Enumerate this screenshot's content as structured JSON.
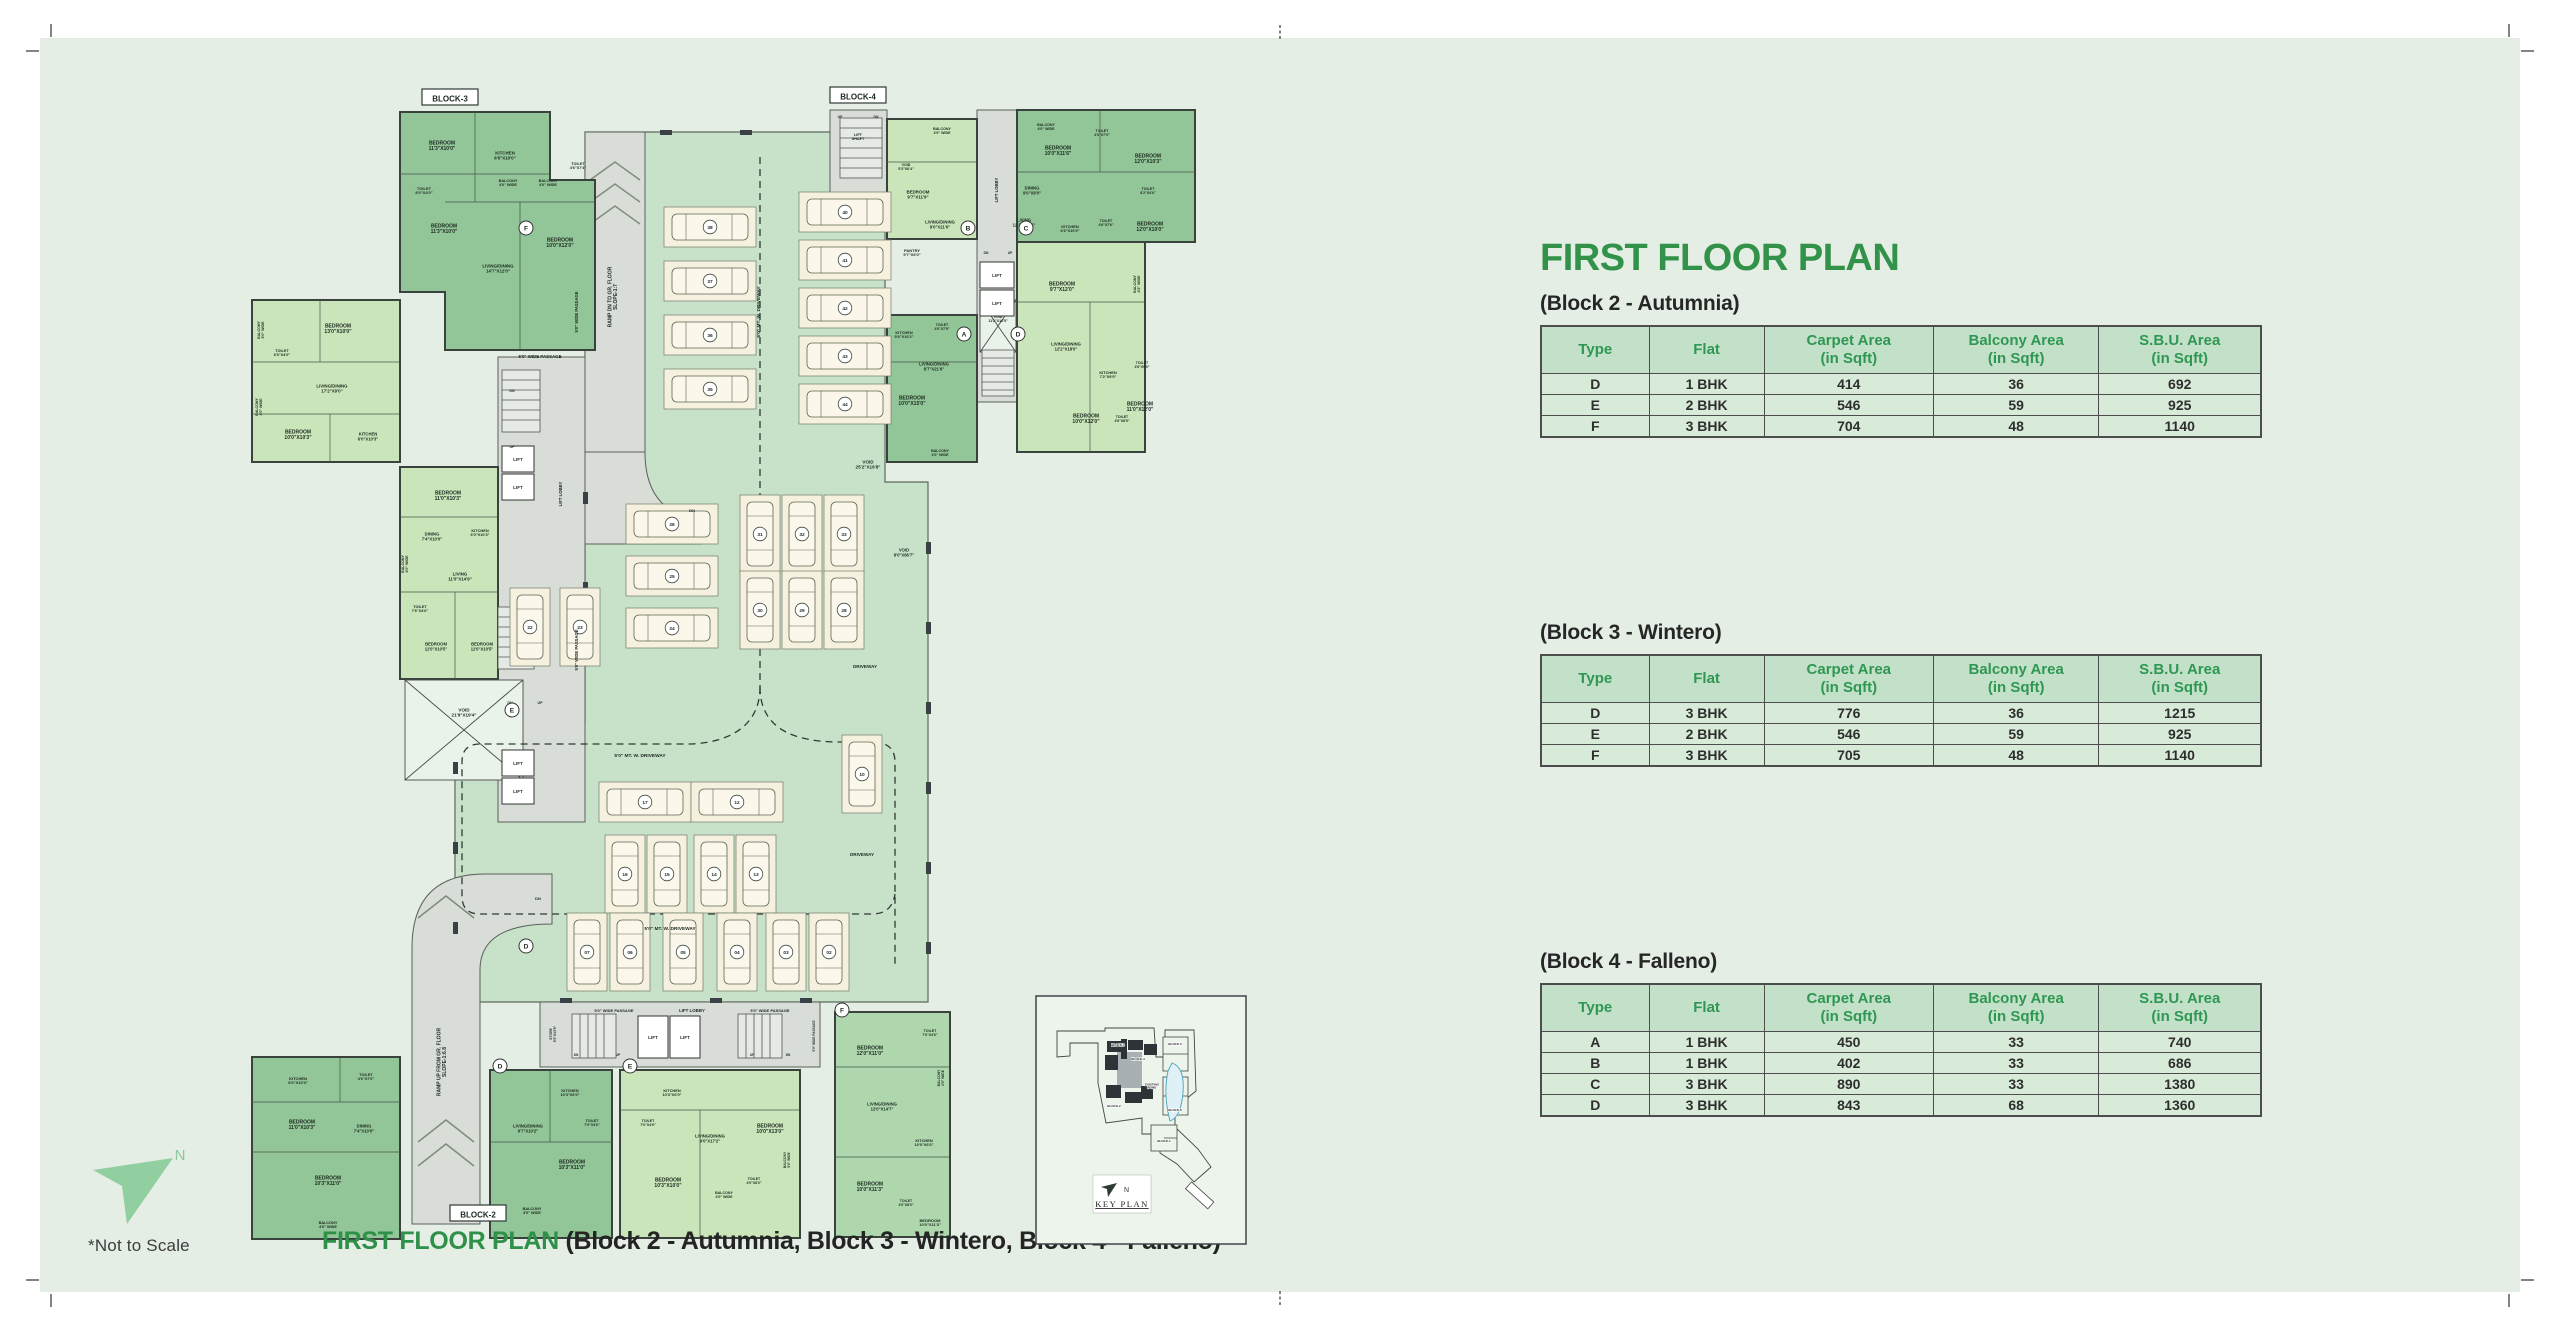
{
  "header": {
    "title": "FIRST FLOOR PLAN"
  },
  "tables": [
    {
      "caption": "(Block 2 - Autumnia)",
      "columns": [
        "Type",
        "Flat",
        "Carpet Area\n(in Sqft)",
        "Balcony Area\n(in Sqft)",
        "S.B.U. Area\n(in Sqft)"
      ],
      "rows": [
        [
          "D",
          "1 BHK",
          "414",
          "36",
          "692"
        ],
        [
          "E",
          "2 BHK",
          "546",
          "59",
          "925"
        ],
        [
          "F",
          "3 BHK",
          "704",
          "48",
          "1140"
        ]
      ]
    },
    {
      "caption": "(Block 3 - Wintero)",
      "columns": [
        "Type",
        "Flat",
        "Carpet Area\n(in Sqft)",
        "Balcony Area\n(in Sqft)",
        "S.B.U. Area\n(in Sqft)"
      ],
      "rows": [
        [
          "D",
          "3 BHK",
          "776",
          "36",
          "1215"
        ],
        [
          "E",
          "2 BHK",
          "546",
          "59",
          "925"
        ],
        [
          "F",
          "3 BHK",
          "705",
          "48",
          "1140"
        ]
      ]
    },
    {
      "caption": "(Block 4 - Falleno)",
      "columns": [
        "Type",
        "Flat",
        "Carpet Area\n(in Sqft)",
        "Balcony Area\n(in Sqft)",
        "S.B.U. Area\n(in Sqft)"
      ],
      "rows": [
        [
          "A",
          "1 BHK",
          "450",
          "33",
          "740"
        ],
        [
          "B",
          "1 BHK",
          "402",
          "33",
          "686"
        ],
        [
          "C",
          "3 BHK",
          "890",
          "33",
          "1380"
        ],
        [
          "D",
          "3 BHK",
          "843",
          "68",
          "1360"
        ]
      ]
    }
  ],
  "footer": {
    "not_to_scale": "*Not to Scale",
    "caption_green": "FIRST FLOOR PLAN ",
    "caption_blocks": "(Block 2 - Autumnia, Block 3 - Wintero, Block 4 - Falleno)"
  },
  "north": {
    "label": "N"
  },
  "keyplan": {
    "title": "KEY PLAN",
    "north_label": "N",
    "labels": [
      {
        "t": "BLOCK-3",
        "x": 83,
        "y": 51,
        "s": 3
      },
      {
        "t": "BLOCK-4",
        "x": 103,
        "y": 65,
        "s": 3
      },
      {
        "t": "BLOCK-2",
        "x": 79,
        "y": 112,
        "s": 3
      },
      {
        "t": "BLOCK-5",
        "x": 140,
        "y": 50,
        "s": 3
      },
      {
        "t": "BLOCK-6",
        "x": 140,
        "y": 116,
        "s": 3
      },
      {
        "t": "BLOCK-1",
        "x": 129,
        "y": 147,
        "s": 3
      },
      {
        "t": "EXISTING\nPOND",
        "x": 117,
        "y": 92,
        "s": 3
      }
    ]
  },
  "colors": {
    "accent_green": "#339249",
    "table_header_green": "#2f9753",
    "sheet_mint": "#e4eee5",
    "slab_green": "#c8e2c9",
    "unit_dark": "#92c597",
    "unit_light": "#cbe5ba",
    "gray_area": "#d9ddd8"
  },
  "plan": {
    "lift_label": "LIFT",
    "block_tags": [
      {
        "t": "BLOCK-3",
        "x": 210,
        "y": 36
      },
      {
        "t": "BLOCK-4",
        "x": 618,
        "y": 34
      },
      {
        "t": "BLOCK-2",
        "x": 238,
        "y": 1152
      }
    ],
    "unit_circles": [
      {
        "t": "F",
        "x": 286,
        "y": 166
      },
      {
        "t": "E",
        "x": 272,
        "y": 648
      },
      {
        "t": "D",
        "x": 286,
        "y": 884
      },
      {
        "t": "B",
        "x": 728,
        "y": 166
      },
      {
        "t": "C",
        "x": 786,
        "y": 166
      },
      {
        "t": "A",
        "x": 724,
        "y": 272
      },
      {
        "t": "D",
        "x": 778,
        "y": 272
      },
      {
        "t": "D",
        "x": 260,
        "y": 1004
      },
      {
        "t": "E",
        "x": 390,
        "y": 1004
      },
      {
        "t": "F",
        "x": 602,
        "y": 948
      }
    ],
    "parking": [
      {
        "n": "38",
        "x": 470,
        "y": 165,
        "o": "h"
      },
      {
        "n": "37",
        "x": 470,
        "y": 219,
        "o": "h"
      },
      {
        "n": "36",
        "x": 470,
        "y": 273,
        "o": "h"
      },
      {
        "n": "35",
        "x": 470,
        "y": 327,
        "o": "h"
      },
      {
        "n": "40",
        "x": 605,
        "y": 150,
        "o": "h"
      },
      {
        "n": "41",
        "x": 605,
        "y": 198,
        "o": "h"
      },
      {
        "n": "42",
        "x": 605,
        "y": 246,
        "o": "h"
      },
      {
        "n": "43",
        "x": 605,
        "y": 294,
        "o": "h"
      },
      {
        "n": "44",
        "x": 605,
        "y": 342,
        "o": "h"
      },
      {
        "n": "26",
        "x": 432,
        "y": 462,
        "o": "h"
      },
      {
        "n": "25",
        "x": 432,
        "y": 514,
        "o": "h"
      },
      {
        "n": "24",
        "x": 432,
        "y": 566,
        "o": "h"
      },
      {
        "n": "22",
        "x": 290,
        "y": 565,
        "o": "v"
      },
      {
        "n": "23",
        "x": 340,
        "y": 565,
        "o": "v"
      },
      {
        "n": "31",
        "x": 520,
        "y": 472,
        "o": "v"
      },
      {
        "n": "32",
        "x": 562,
        "y": 472,
        "o": "v"
      },
      {
        "n": "33",
        "x": 604,
        "y": 472,
        "o": "v"
      },
      {
        "n": "30",
        "x": 520,
        "y": 548,
        "o": "v"
      },
      {
        "n": "29",
        "x": 562,
        "y": 548,
        "o": "v"
      },
      {
        "n": "28",
        "x": 604,
        "y": 548,
        "o": "v"
      },
      {
        "n": "17",
        "x": 405,
        "y": 740,
        "o": "h"
      },
      {
        "n": "12",
        "x": 497,
        "y": 740,
        "o": "h"
      },
      {
        "n": "16",
        "x": 385,
        "y": 812,
        "o": "v"
      },
      {
        "n": "15",
        "x": 427,
        "y": 812,
        "o": "v"
      },
      {
        "n": "14",
        "x": 474,
        "y": 812,
        "o": "v"
      },
      {
        "n": "13",
        "x": 516,
        "y": 812,
        "o": "v"
      },
      {
        "n": "10",
        "x": 622,
        "y": 712,
        "o": "v"
      },
      {
        "n": "07",
        "x": 347,
        "y": 890,
        "o": "v"
      },
      {
        "n": "06",
        "x": 390,
        "y": 890,
        "o": "v"
      },
      {
        "n": "05",
        "x": 443,
        "y": 890,
        "o": "v"
      },
      {
        "n": "04",
        "x": 497,
        "y": 890,
        "o": "v"
      },
      {
        "n": "03",
        "x": 546,
        "y": 890,
        "o": "v"
      },
      {
        "n": "02",
        "x": 589,
        "y": 890,
        "o": "v"
      }
    ],
    "texts": [
      {
        "t": "BEDROOM\n11'3\"X10'0\"",
        "x": 202,
        "y": 85
      },
      {
        "t": "KITCHEN\n6'6\"X10'0\"",
        "x": 265,
        "y": 95,
        "s": 4.4
      },
      {
        "t": "TOILET\n8'0\"X4'0\"",
        "x": 184,
        "y": 130,
        "s": 4
      },
      {
        "t": "BALCONY\n4'0\" WIDE",
        "x": 268,
        "y": 122,
        "s": 3.8
      },
      {
        "t": "BALCONY\n4'0\" WIDE",
        "x": 308,
        "y": 122,
        "s": 3.8
      },
      {
        "t": "TOILET\n4'6\"X7'4\"",
        "x": 338,
        "y": 105,
        "s": 3.8
      },
      {
        "t": "BEDROOM\n11'3\"X10'0\"",
        "x": 204,
        "y": 168
      },
      {
        "t": "LIVING/DINING\n14'7\"X12'0\"",
        "x": 258,
        "y": 208,
        "s": 4.4
      },
      {
        "t": "BEDROOM\n10'0\"X12'0\"",
        "x": 320,
        "y": 182
      },
      {
        "t": "BEDROOM\n13'0\"X10'0\"",
        "x": 98,
        "y": 268
      },
      {
        "t": "TOILET\n6'0\"X4'0\"",
        "x": 42,
        "y": 292,
        "s": 3.8
      },
      {
        "t": "BALCONY\n5'0\" WIDE",
        "x": 22,
        "y": 268,
        "r": -90,
        "s": 3.6
      },
      {
        "t": "LIVING/DINING\n17'2\"X9'0\"",
        "x": 92,
        "y": 328,
        "s": 4.4
      },
      {
        "t": "BALCONY\n4'0\" WIDE",
        "x": 20,
        "y": 345,
        "r": -90,
        "s": 3.6
      },
      {
        "t": "BEDROOM\n10'0\"X10'3\"",
        "x": 58,
        "y": 374
      },
      {
        "t": "KITCHEN\n6'0\"X10'3\"",
        "x": 128,
        "y": 376,
        "s": 4.2
      },
      {
        "t": "BEDROOM\n11'0\"X10'3\"",
        "x": 208,
        "y": 435
      },
      {
        "t": "KITCHEN\n6'0\"X10'3\"",
        "x": 240,
        "y": 472,
        "s": 3.9
      },
      {
        "t": "DINING\n7'4\"X10'0\"",
        "x": 192,
        "y": 476,
        "s": 4.2
      },
      {
        "t": "LIVING\n11'0\"X14'9\"",
        "x": 220,
        "y": 516,
        "s": 4.4
      },
      {
        "t": "TOILET\n7'6\"X4'6\"",
        "x": 180,
        "y": 548,
        "s": 3.8
      },
      {
        "t": "BEDROOM\n11'0\"X10'5\"",
        "x": 196,
        "y": 586,
        "s": 4.2
      },
      {
        "t": "BEDROOM\n11'0\"X10'5\"",
        "x": 242,
        "y": 586,
        "s": 4.2
      },
      {
        "t": "BALCONY\n4'0\" WIDE",
        "x": 166,
        "y": 502,
        "r": -90,
        "s": 3.6
      },
      {
        "t": "VOID\n21'9\"X19'4\"",
        "x": 224,
        "y": 652,
        "s": 4.6
      },
      {
        "t": "VOID\n11'2\"X16'5\"",
        "x": 758,
        "y": 258,
        "s": 3.6
      },
      {
        "t": "TOILET\n4'6\"X7'0\"",
        "x": 126,
        "y": 1016,
        "s": 3.8
      },
      {
        "t": "KITCHEN\n6'0\"X10'3\"",
        "x": 58,
        "y": 1020,
        "s": 4
      },
      {
        "t": "BEDROOM\n11'0\"X10'3\"",
        "x": 62,
        "y": 1064
      },
      {
        "t": "DINING\n7'4\"X10'0\"",
        "x": 124,
        "y": 1068,
        "s": 4.2
      },
      {
        "t": "BEDROOM\n10'3\"X11'0\"",
        "x": 88,
        "y": 1120
      },
      {
        "t": "BALCONY\n4'0\" WIDE",
        "x": 88,
        "y": 1164,
        "s": 3.8
      },
      {
        "t": "5'0\" WIDE PASSAGE",
        "x": 300,
        "y": 296,
        "s": 4.4,
        "b": 1
      },
      {
        "t": "DN",
        "x": 272,
        "y": 330,
        "s": 3.6
      },
      {
        "t": "UP",
        "x": 272,
        "y": 386,
        "s": 3.6
      },
      {
        "t": "5'0\" WIDE PASSAGE",
        "x": 338,
        "y": 250,
        "r": -90,
        "s": 4.2,
        "b": 1
      },
      {
        "t": "LIFT LOBBY",
        "x": 322,
        "y": 432,
        "r": -90,
        "s": 4.2
      },
      {
        "t": "5'0\" WIDE PASSAGE",
        "x": 338,
        "y": 588,
        "r": -90,
        "s": 4.2,
        "b": 1
      },
      {
        "t": "DN",
        "x": 270,
        "y": 642,
        "s": 3.6
      },
      {
        "t": "UP",
        "x": 300,
        "y": 642,
        "s": 3.6
      },
      {
        "t": "RAMP DN TO GR. FLOOR\nSLOPE-1:7",
        "x": 374,
        "y": 235,
        "r": -90,
        "s": 5,
        "b": 1
      },
      {
        "t": "DN",
        "x": 452,
        "y": 450,
        "s": 4
      },
      {
        "t": "RAMP UP FROM GR. FLOOR\nSLOPE-1:6.8",
        "x": 203,
        "y": 1000,
        "r": -90,
        "s": 5,
        "b": 1
      },
      {
        "t": "DN",
        "x": 298,
        "y": 838,
        "s": 4
      },
      {
        "t": "5'0\" MT. W. DRIVEWAY",
        "x": 520,
        "y": 250,
        "r": -90,
        "s": 4.8,
        "b": 1
      },
      {
        "t": "5'0\" MT. W. DRIVEWAY",
        "x": 400,
        "y": 695,
        "s": 4.8,
        "b": 1
      },
      {
        "t": "5'0\" MT. W. DRIVEWAY",
        "x": 430,
        "y": 868,
        "s": 4.8,
        "b": 1
      },
      {
        "t": "DRIVEWAY",
        "x": 625,
        "y": 606,
        "s": 4.6,
        "b": 1
      },
      {
        "t": "DRIVEWAY",
        "x": 622,
        "y": 794,
        "s": 4.6,
        "b": 1
      },
      {
        "t": "VOID\n25'2\"X16'8\"",
        "x": 628,
        "y": 404,
        "s": 4.6
      },
      {
        "t": "VOID\n8'0\"X86'7\"",
        "x": 664,
        "y": 492,
        "s": 4.2
      },
      {
        "t": "LIFT\nSHAFT",
        "x": 618,
        "y": 76,
        "s": 3.8
      },
      {
        "t": "UP",
        "x": 600,
        "y": 56,
        "s": 3.4
      },
      {
        "t": "DN",
        "x": 636,
        "y": 56,
        "s": 3.4
      },
      {
        "t": "VOID\n5'3\"X6'4\"",
        "x": 666,
        "y": 106,
        "s": 3.6
      },
      {
        "t": "BALCONY\n4'0\" WIDE",
        "x": 702,
        "y": 70,
        "s": 3.6
      },
      {
        "t": "BEDROOM\n9'7\"X11'9\"",
        "x": 678,
        "y": 134,
        "s": 4.4
      },
      {
        "t": "LIVING/DINING\n9'0\"X21'6\"",
        "x": 700,
        "y": 164,
        "s": 4.2
      },
      {
        "t": "PANTRY\n9'7\"X6'0\"",
        "x": 672,
        "y": 192,
        "s": 4
      },
      {
        "t": "BALCONY\n4'0\" WIDE",
        "x": 806,
        "y": 66,
        "s": 3.6
      },
      {
        "t": "BEDROOM\n10'0\"X11'6\"",
        "x": 818,
        "y": 90
      },
      {
        "t": "TOILET\n4'6\"X7'0\"",
        "x": 862,
        "y": 72,
        "s": 3.6
      },
      {
        "t": "BEDROOM\n12'0\"X10'3\"",
        "x": 908,
        "y": 98
      },
      {
        "t": "DINING\n9'0\"X8'0\"",
        "x": 792,
        "y": 130,
        "s": 4.2
      },
      {
        "t": "TOILET\n8'2\"X4'6\"",
        "x": 908,
        "y": 130,
        "s": 3.6
      },
      {
        "t": "LIVING\n12'3\"X13'6\"",
        "x": 784,
        "y": 162,
        "s": 4.2
      },
      {
        "t": "KITCHEN\n6'6\"X10'0\"",
        "x": 830,
        "y": 168,
        "s": 3.9
      },
      {
        "t": "TOILET\n4'6\"X7'6\"",
        "x": 866,
        "y": 162,
        "s": 3.5
      },
      {
        "t": "BEDROOM\n12'0\"X10'0\"",
        "x": 910,
        "y": 166
      },
      {
        "t": "LIFT LOBBY",
        "x": 758,
        "y": 128,
        "r": -90,
        "s": 4.2
      },
      {
        "t": "DN",
        "x": 746,
        "y": 192,
        "s": 3.3
      },
      {
        "t": "UP",
        "x": 770,
        "y": 192,
        "s": 3.3
      },
      {
        "t": "BEDROOM\n9'7\"X12'0\"",
        "x": 822,
        "y": 226
      },
      {
        "t": "BALCONY\n4'6\" WIDE",
        "x": 898,
        "y": 222,
        "r": -90,
        "s": 3.6
      },
      {
        "t": "LIVING/DINING\n12'2\"X18'0\"",
        "x": 826,
        "y": 286,
        "s": 4.2
      },
      {
        "t": "KITCHEN\n7'2\"X9'0\"",
        "x": 868,
        "y": 314,
        "s": 3.9
      },
      {
        "t": "TOILET\n4'6\"X9'0\"",
        "x": 902,
        "y": 304,
        "s": 3.5
      },
      {
        "t": "BEDROOM\n11'0\"X12'0\"",
        "x": 900,
        "y": 346
      },
      {
        "t": "BEDROOM\n10'0\"X12'0\"",
        "x": 846,
        "y": 358
      },
      {
        "t": "TOILET\n4'6\"X8'5\"",
        "x": 882,
        "y": 358,
        "s": 3.5
      },
      {
        "t": "KITCHEN\n5'6\"X10'2\"",
        "x": 664,
        "y": 274,
        "s": 3.9
      },
      {
        "t": "TOILET\n4'0\"X7'5\"",
        "x": 702,
        "y": 266,
        "s": 3.5
      },
      {
        "t": "LIVING/DINING\n8'7\"X21'6\"",
        "x": 694,
        "y": 306,
        "s": 4.2
      },
      {
        "t": "BEDROOM\n10'0\"X15'0\"",
        "x": 672,
        "y": 340
      },
      {
        "t": "BALCONY\n4'0\" WIDE",
        "x": 700,
        "y": 392,
        "s": 3.6
      },
      {
        "t": "STORE\n5'3\"X13'9\"",
        "x": 314,
        "y": 972,
        "r": -90,
        "s": 3.4
      },
      {
        "t": "5'0\" WIDE PASSAGE",
        "x": 374,
        "y": 950,
        "s": 4,
        "b": 1
      },
      {
        "t": "LIFT LOBBY",
        "x": 452,
        "y": 950,
        "s": 4.4
      },
      {
        "t": "5'0\" WIDE PASSAGE",
        "x": 530,
        "y": 950,
        "s": 4,
        "b": 1
      },
      {
        "t": "5'0\" WIDE PASSAGE",
        "x": 575,
        "y": 974,
        "r": -90,
        "s": 3.2
      },
      {
        "t": "DN",
        "x": 336,
        "y": 994,
        "s": 3.2
      },
      {
        "t": "UP",
        "x": 378,
        "y": 994,
        "s": 3.2
      },
      {
        "t": "UP",
        "x": 512,
        "y": 994,
        "s": 3.2
      },
      {
        "t": "DN",
        "x": 548,
        "y": 994,
        "s": 3.2
      },
      {
        "t": "KITCHEN\n10'3\"X6'0\"",
        "x": 330,
        "y": 1032,
        "s": 3.9
      },
      {
        "t": "TOILET\n7'0\"X4'6\"",
        "x": 352,
        "y": 1062,
        "s": 3.6
      },
      {
        "t": "LIVING/DINING\n9'7\"X10'2\"",
        "x": 288,
        "y": 1068,
        "s": 4.2
      },
      {
        "t": "BEDROOM\n10'3\"X11'0\"",
        "x": 332,
        "y": 1104
      },
      {
        "t": "BALCONY\n4'0\" WIDE",
        "x": 292,
        "y": 1150,
        "s": 3.8
      },
      {
        "t": "KITCHEN\n10'3\"X6'0\"",
        "x": 432,
        "y": 1032,
        "s": 3.9
      },
      {
        "t": "TOILET\n7'0\"X4'6\"",
        "x": 408,
        "y": 1062,
        "s": 3.6
      },
      {
        "t": "LIVING/DINING\n9'0\"X17'2\"",
        "x": 470,
        "y": 1078,
        "s": 4.2
      },
      {
        "t": "BEDROOM\n10'0\"X13'0\"",
        "x": 530,
        "y": 1068
      },
      {
        "t": "BEDROOM\n10'3\"X10'0\"",
        "x": 428,
        "y": 1122
      },
      {
        "t": "BALCONY\n4'0\" WIDE",
        "x": 484,
        "y": 1134,
        "s": 3.6
      },
      {
        "t": "TOILET\n4'0\"X8'0\"",
        "x": 514,
        "y": 1120,
        "s": 3.5
      },
      {
        "t": "BALCONY\n5'0\" WIDE",
        "x": 548,
        "y": 1098,
        "r": -90,
        "s": 3.3
      },
      {
        "t": "BEDROOM\n12'0\"X11'0\"",
        "x": 630,
        "y": 990
      },
      {
        "t": "TOILET\n7'0\"X4'6\"",
        "x": 690,
        "y": 972,
        "s": 3.6
      },
      {
        "t": "BALCONY\n4'0\" WIDE",
        "x": 702,
        "y": 1016,
        "r": -90,
        "s": 3.4
      },
      {
        "t": "LIVING/DINING\n12'0\"X14'7\"",
        "x": 642,
        "y": 1046,
        "s": 4.2
      },
      {
        "t": "KITCHEN\n10'0\"X6'6\"",
        "x": 684,
        "y": 1082,
        "s": 3.9
      },
      {
        "t": "BEDROOM\n10'0\"X11'3\"",
        "x": 630,
        "y": 1126
      },
      {
        "t": "TOILET\n4'0\"X8'0\"",
        "x": 666,
        "y": 1142,
        "s": 3.5
      },
      {
        "t": "BEDROOM\n10'0\"X11'3\"",
        "x": 690,
        "y": 1162,
        "s": 4
      }
    ]
  }
}
